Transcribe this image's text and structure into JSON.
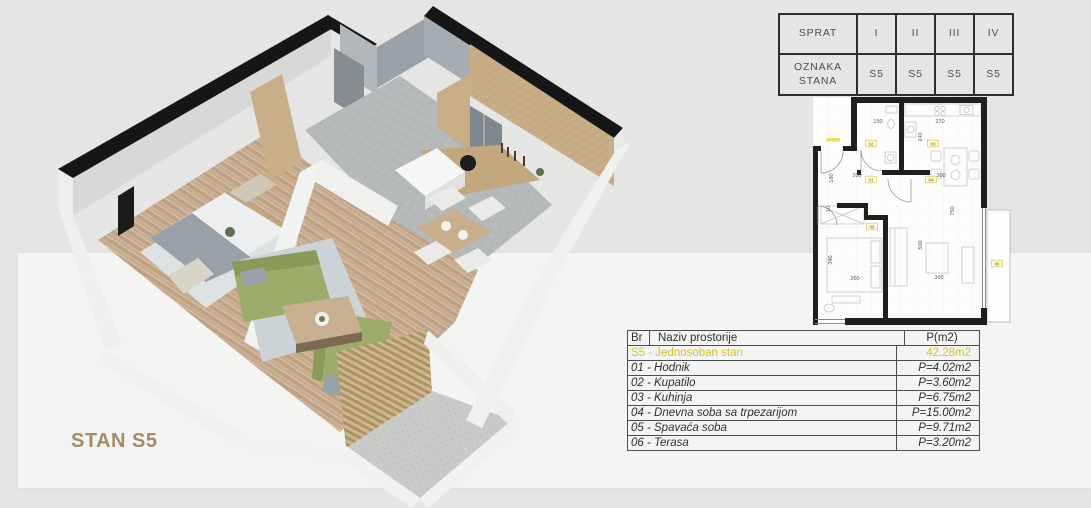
{
  "page": {
    "background_color": "#e5e6e4",
    "panel_color": "#f4f5f3"
  },
  "plan_label": {
    "text": "STAN S5",
    "color": "#a68c66"
  },
  "floors_table": {
    "rows": [
      {
        "label": "SPRAT",
        "cols": [
          "I",
          "II",
          "III",
          "IV"
        ]
      },
      {
        "label": "OZNAKA STANA",
        "cols": [
          "S5",
          "S5",
          "S5",
          "S5"
        ]
      }
    ]
  },
  "rooms_table": {
    "header": {
      "br": "Br",
      "name": "Naziv prostorije",
      "area": "P(m2)"
    },
    "highlight": {
      "name": "S5 - Jednosoban stan",
      "area": "42.28m2",
      "color": "#d2c42e"
    },
    "rows": [
      {
        "name": "01 - Hodnik",
        "area": "P=4.02m2"
      },
      {
        "name": "02 - Kupatilo",
        "area": "P=3.60m2"
      },
      {
        "name": "03 - Kuhinja",
        "area": "P=6.75m2"
      },
      {
        "name": "04 - Dnevna soba sa trpezarijom",
        "area": "P=15.00m2"
      },
      {
        "name": "05 - Spavaća soba",
        "area": "P=9.71m2"
      },
      {
        "name": "06 - Terasa",
        "area": "P=3.20m2"
      }
    ]
  },
  "plan2d": {
    "dimensions": [
      {
        "text": "150",
        "x": 878,
        "y": 123,
        "rot": 0
      },
      {
        "text": "270",
        "x": 940,
        "y": 123,
        "rot": 0
      },
      {
        "text": "240",
        "x": 922,
        "y": 137,
        "rot": 90
      },
      {
        "text": "180",
        "x": 833,
        "y": 178,
        "rot": 90
      },
      {
        "text": "200",
        "x": 857,
        "y": 177,
        "rot": 0
      },
      {
        "text": "300",
        "x": 941,
        "y": 177,
        "rot": 0
      },
      {
        "text": "10",
        "x": 830,
        "y": 209,
        "rot": 90
      },
      {
        "text": "390",
        "x": 832,
        "y": 260,
        "rot": 90
      },
      {
        "text": "260",
        "x": 855,
        "y": 280,
        "rot": 0
      },
      {
        "text": "500",
        "x": 922,
        "y": 245,
        "rot": 90
      },
      {
        "text": "300",
        "x": 939,
        "y": 279,
        "rot": 0
      },
      {
        "text": "750",
        "x": 954,
        "y": 211,
        "rot": 90
      }
    ],
    "room_tags": [
      {
        "text": "01",
        "x": 871,
        "y": 181
      },
      {
        "text": "02",
        "x": 871,
        "y": 145
      },
      {
        "text": "03",
        "x": 933,
        "y": 145
      },
      {
        "text": "04",
        "x": 931,
        "y": 181
      },
      {
        "text": "05",
        "x": 872,
        "y": 228
      },
      {
        "text": "06",
        "x": 997,
        "y": 265
      }
    ]
  }
}
